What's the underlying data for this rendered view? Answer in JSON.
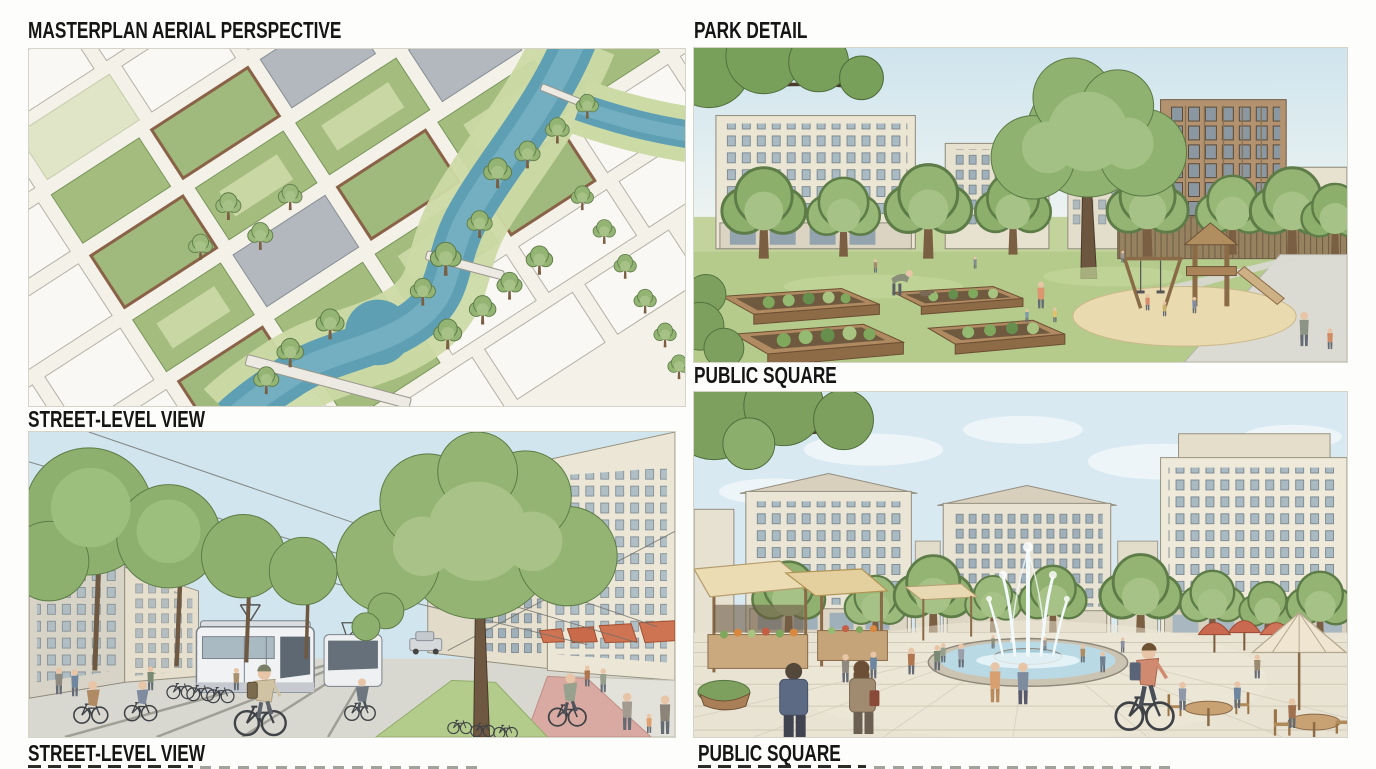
{
  "page": {
    "background": "#fdfdfb",
    "label_color": "#151515"
  },
  "panels": [
    {
      "id": "masterplan-aerial-perspective",
      "title": "MASTERPLAN AERIAL PERSPECTIVE"
    },
    {
      "id": "park-detail",
      "title": "PARK DETAIL"
    },
    {
      "id": "street-level-view",
      "title": "STREET-LEVEL VIEW",
      "caption": "STREET-LEVEL VIEW"
    },
    {
      "id": "public-square",
      "title": "PUBLIC SQUARE",
      "caption": "PUBLIC SQUARE"
    }
  ],
  "palette": {
    "paper": "#f3f1e8",
    "sky": "#d2e5ee",
    "water": "#5f9fb4",
    "foliage": "#94b474",
    "green_roof": "#a4bd7f",
    "brick": "#a07a5c",
    "lawn": "#b4cb8b",
    "plaza": "#e9e3d3",
    "awning": "#cf7452",
    "bike_lane": "#d9aaa2",
    "sand": "#e9dab0"
  }
}
